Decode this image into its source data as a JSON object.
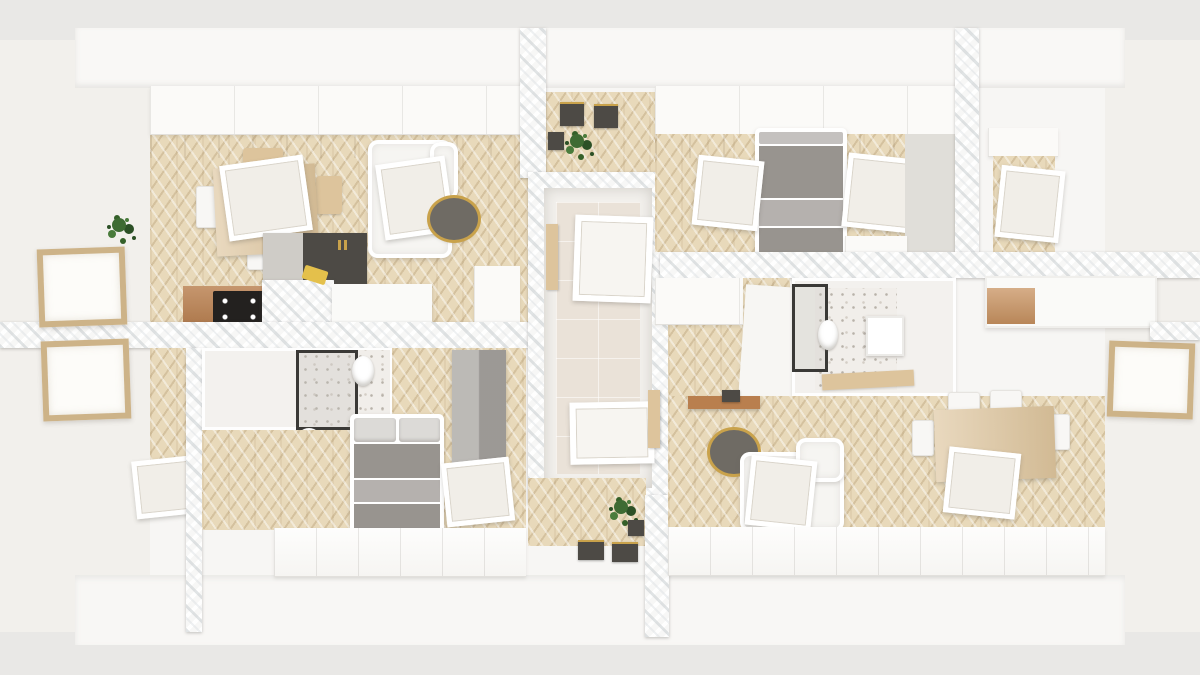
{
  "title": "Attic floor plan – 3D top-down render of two mirrored apartments",
  "palette": {
    "background": "#e9e8e6",
    "roof_white": "#f7f6f4",
    "gable_wall": "#f2f0ec",
    "floor_wood": "#e8d9ba",
    "marble_base": "#f7f7f6",
    "tile_floor": "#eae2d8",
    "terrazzo": "#f1eeea",
    "cabinet_white": "#fbfaf8",
    "cabinet_dark": "#4d4a45",
    "counter_wood": "#b97f4e",
    "table_wood": "#ddc49c",
    "sofa_white": "#f6f5f2",
    "bed_gray": "#98948f",
    "bed_fold": "#b5b1ae",
    "pillow": "#dcdad7",
    "coffee_table": "#6f6b64",
    "gold": "#c9a24b",
    "plant_green": "#3e6b33",
    "plant_dark": "#2c5026",
    "window_frame_wood": "#cdb388",
    "glass": "#fdfcf9",
    "shower_frame": "#3a3936"
  },
  "scene": {
    "view": "top-down cutaway 3D render",
    "structure": [
      "white pitched roof planes",
      "marble-textured cut walls",
      "central stair landing with two apartment doors",
      "knee-wall storage cabinets along eaves",
      "gable walls with wood-framed windows"
    ],
    "left_apartment": {
      "rooms": [
        {
          "name": "living-dining-kitchen",
          "floor": "herringbone oak",
          "furniture": [
            "dining table with chairs",
            "roof skylight over dining",
            "potted plant",
            "white sofa",
            "roof skylight over sofa",
            "round coffee table with gold rim",
            "dark kitchen cabinets",
            "wood counter with black cooktop",
            "marble-front island with gold towel"
          ]
        },
        {
          "name": "bathroom",
          "floor": "terrazzo",
          "furniture": [
            "glass shower",
            "toilet",
            "washbasin"
          ]
        },
        {
          "name": "bedroom",
          "floor": "herringbone oak",
          "furniture": [
            "double bed with gray duvet",
            "gray wardrobe",
            "roof skylight"
          ]
        },
        {
          "name": "side-hallway",
          "floor": "herringbone oak",
          "furniture": [
            "roof skylight"
          ]
        }
      ]
    },
    "right_apartment": {
      "rooms": [
        {
          "name": "bedroom",
          "floor": "herringbone oak",
          "furniture": [
            "double bed with gray duvet",
            "two roof skylights",
            "low white dresser"
          ]
        },
        {
          "name": "entry-hall",
          "floor": "herringbone oak",
          "furniture": [
            "white wardrobe",
            "partition wall"
          ]
        },
        {
          "name": "bathroom",
          "floor": "terrazzo",
          "furniture": [
            "glass shower",
            "toilet",
            "vanity unit",
            "wood bath mat"
          ]
        },
        {
          "name": "kitchen",
          "floor": "herringbone oak",
          "furniture": [
            "white counter",
            "wood cabinet front"
          ]
        },
        {
          "name": "living-dining",
          "floor": "herringbone oak",
          "furniture": [
            "round coffee table with gold rim",
            "white sofa",
            "roof skylight over sofa",
            "wood dining table with white chairs",
            "roof skylight over dining",
            "wood wall shelf"
          ]
        },
        {
          "name": "study-nook",
          "floor": "herringbone oak",
          "furniture": [
            "roof skylight"
          ]
        }
      ]
    },
    "stair_landing": {
      "floor": "beige ceramic tile",
      "furniture": [
        "entry door left apartment",
        "entry door right apartment",
        "hanging plant",
        "dark planter",
        "two dark benches with gold legs",
        "wall-mounted coat boxes"
      ]
    }
  }
}
